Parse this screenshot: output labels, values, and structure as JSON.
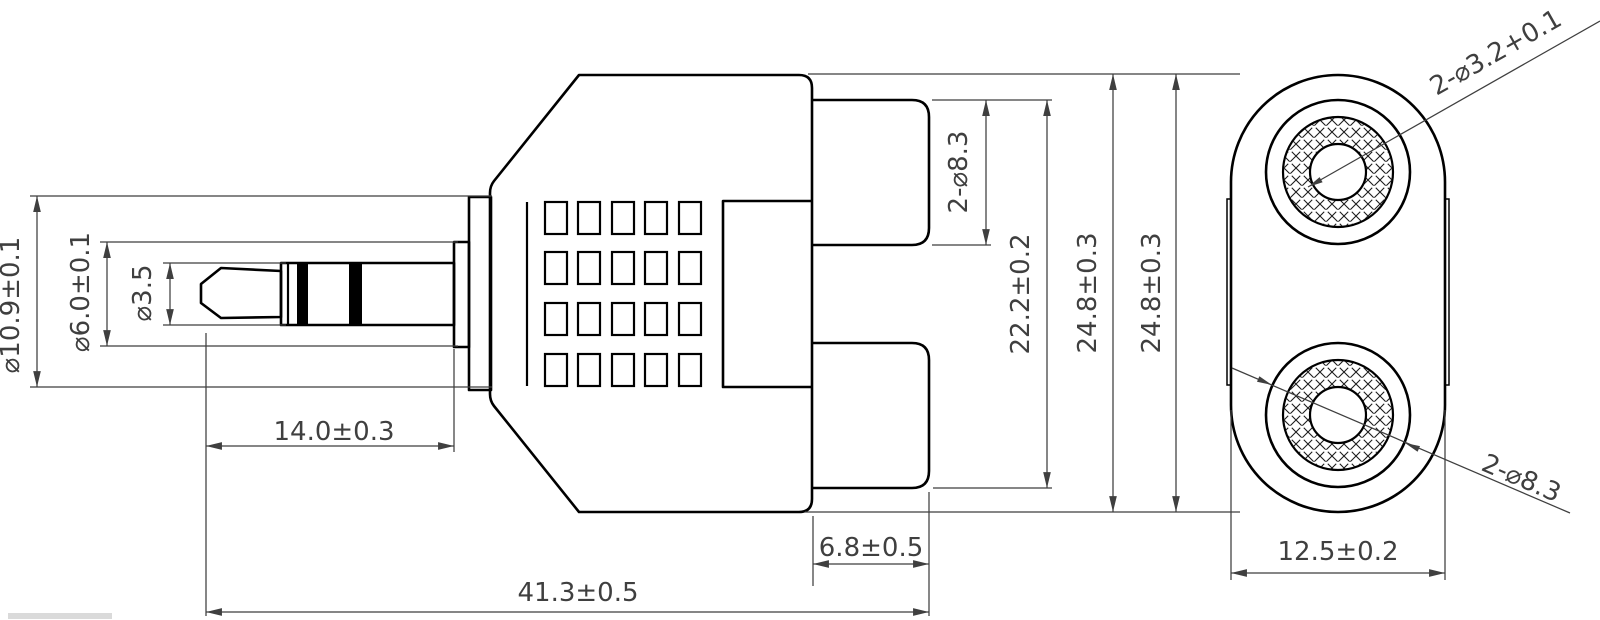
{
  "front_view": {
    "flange_diameter": "⌀10.9±0.1",
    "collar_diameter": "⌀6.0±0.1",
    "tip_diameter": "⌀3.5",
    "plug_length": "14.0±0.3",
    "overall_length": "41.3±0.5",
    "rca_protrusion": "6.8±0.5",
    "rca_barrel_diameter": "2-⌀8.3",
    "rca_outer_span": "22.2±0.2",
    "body_height": "24.8±0.3"
  },
  "side_view": {
    "body_height": "24.8±0.3",
    "body_width": "12.5±0.2",
    "center_hole_diameter": "2-⌀3.2+0.1",
    "rca_barrel_diameter": "2-⌀8.3"
  },
  "colors": {
    "outline": "#000000",
    "dimension": "#3f3f3f",
    "background": "#ffffff"
  }
}
